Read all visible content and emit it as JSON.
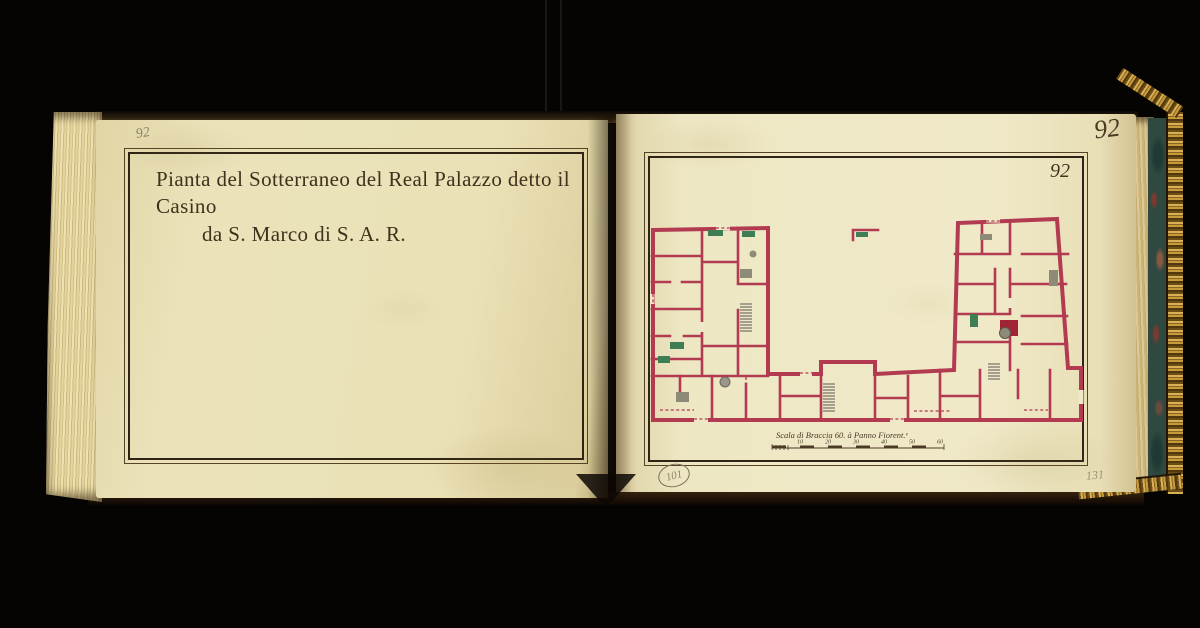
{
  "background_color": "#050403",
  "book": {
    "left_page": {
      "pencil_folio_number": "92",
      "title_line1": "Pianta del Sotterraneo del Real Palazzo detto il Casino",
      "title_line2": "da S. Marco di S. A. R."
    },
    "right_page": {
      "corner_folio_number": "92",
      "plate_number": "92",
      "circled_stamp_number": "101",
      "pencil_note": "131",
      "plan": {
        "type": "architectural-floor-plan",
        "description": "U-shaped basement plan drawn with crimson walls, green and gray fittings, stairs and door openings",
        "scale_caption": "Scala di Braccia 60. à Panno Fiorent.ᵉ",
        "scale_tick_labels": [
          "10",
          "20",
          "30",
          "40",
          "50",
          "60"
        ]
      }
    }
  },
  "colors": {
    "paper_left": "#eae1b6",
    "paper_right": "#f0e9c8",
    "ink": "#40301c",
    "plan_wall": "#b23a51",
    "plan_green": "#3f7d55",
    "plan_gray": "#8d8a78",
    "plan_red_block": "#a02435",
    "gilt": "#c79a3c",
    "marble_teal": "#2f4840",
    "pencil": "#7d725c"
  }
}
